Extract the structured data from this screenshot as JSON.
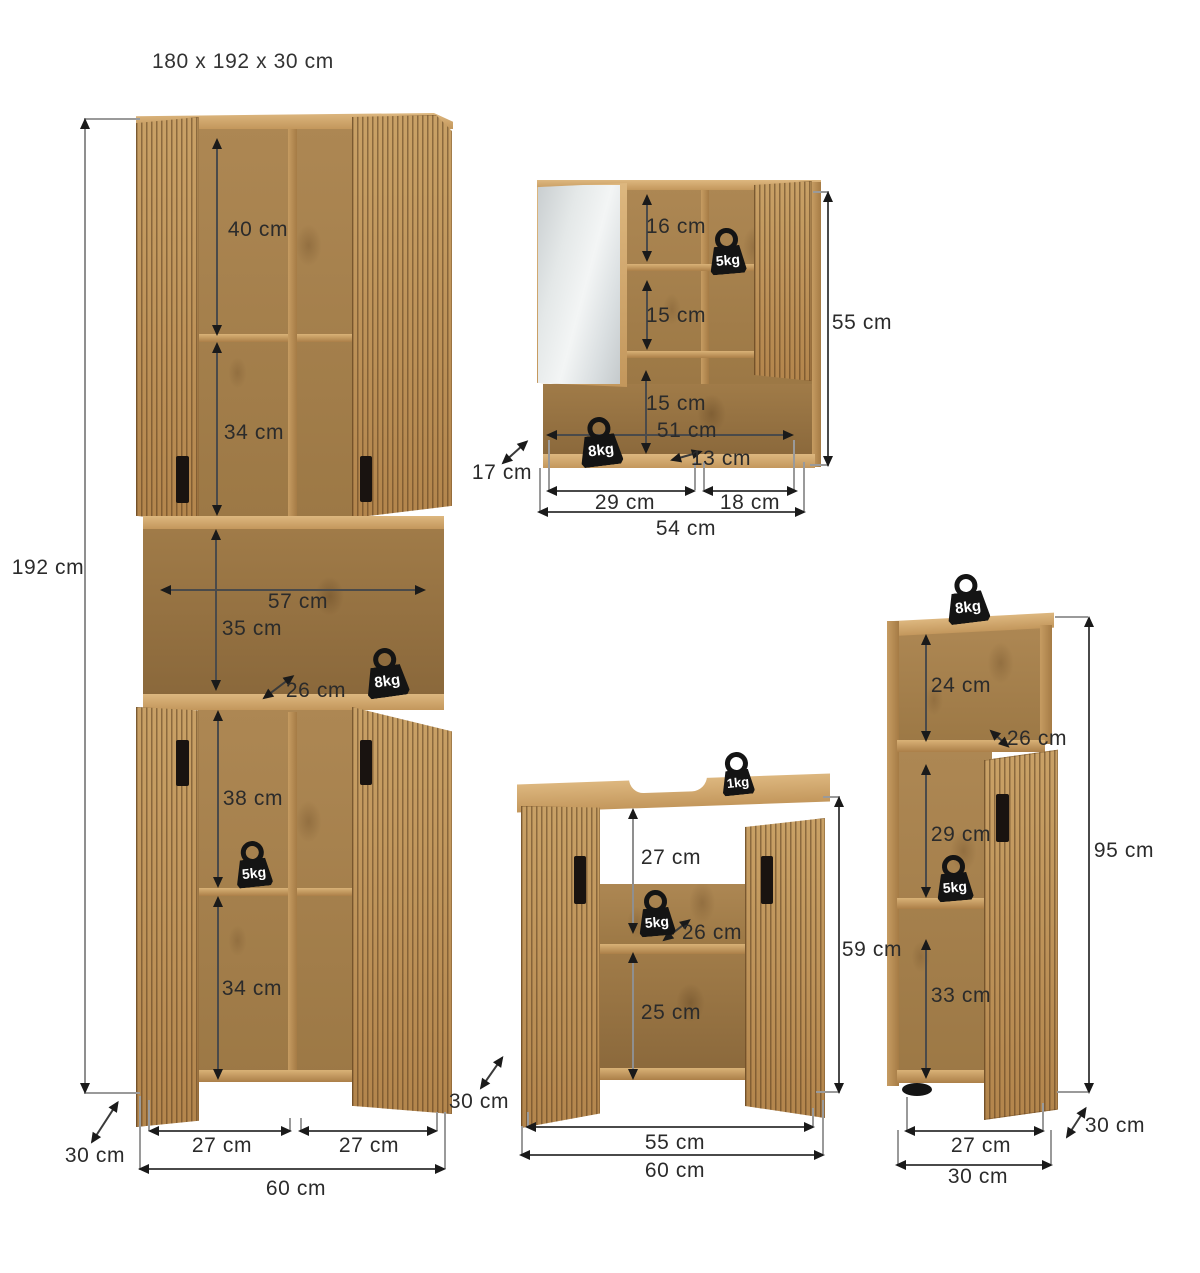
{
  "title": "180 x 192 x 30 cm",
  "tall_cabinet": {
    "height": "192 cm",
    "top_shelf_height": "40 cm",
    "upper_shelf_height": "34 cm",
    "niche_width": "57 cm",
    "niche_height": "35 cm",
    "niche_depth": "26 cm",
    "niche_load": "8kg",
    "lower_shelf_height": "38 cm",
    "lower_load": "5kg",
    "bottom_shelf_height": "34 cm",
    "depth_left": "30 cm",
    "left_door_width": "27 cm",
    "right_door_width": "27 cm",
    "width": "60 cm",
    "depth_right": "30 cm"
  },
  "mirror_cabinet": {
    "top_shelf_height": "16 cm",
    "upper_load": "5kg",
    "middle_shelf_height": "15 cm",
    "bottom_shelf_height": "15 cm",
    "inner_width": "51 cm",
    "bottom_load": "8kg",
    "right_inner_width": "13 cm",
    "height": "55 cm",
    "depth": "17 cm",
    "left_section_width": "29 cm",
    "right_section_width": "18 cm",
    "width": "54 cm"
  },
  "sink_cabinet": {
    "top_load": "1kg",
    "upper_height": "27 cm",
    "shelf_load": "5kg",
    "inner_depth": "26 cm",
    "lower_height": "25 cm",
    "height": "59 cm",
    "inner_width": "55 cm",
    "width": "60 cm"
  },
  "side_cabinet": {
    "top_load": "8kg",
    "top_shelf_height": "24 cm",
    "inner_depth": "26 cm",
    "middle_shelf_height": "29 cm",
    "middle_load": "5kg",
    "bottom_shelf_height": "33 cm",
    "height": "95 cm",
    "inner_width": "27 cm",
    "width": "30 cm",
    "depth": "30 cm"
  },
  "colors": {
    "wood": "#c09862",
    "wood_light": "#d8b37c",
    "wood_dark": "#96713f",
    "slat_groove": "#5f3f1d",
    "line": "#4a4a4a",
    "text": "#2b2b2b",
    "badge": "#141414",
    "mirror": "#e2e6e7"
  }
}
